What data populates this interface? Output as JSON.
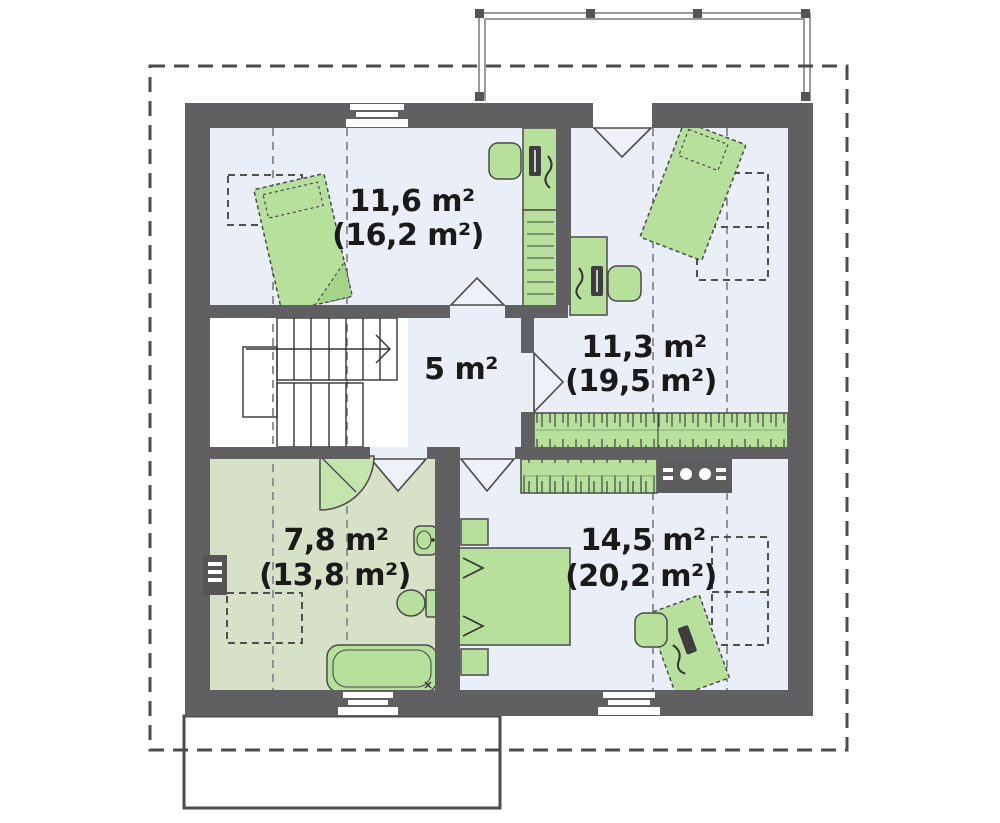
{
  "plan": {
    "type": "floor-plan",
    "floor": "attic storey",
    "rooms": [
      {
        "name": "room-top-left",
        "area": "11,6 m²",
        "total": "(16,2 m²)"
      },
      {
        "name": "room-right",
        "area": "11,3 m²",
        "total": "(19,5 m²)"
      },
      {
        "name": "hall",
        "area": "5 m²"
      },
      {
        "name": "bathroom",
        "area": "7,8 m²",
        "total": "(13,8 m²)"
      },
      {
        "name": "bedroom",
        "area": "14,5 m²",
        "total": "(20,2 m²)"
      }
    ],
    "colors": {
      "wall": "#606062",
      "floor": "#eaeef7",
      "bathroom_floor": "#d6e1c8",
      "stairwell": "#ffffff",
      "furniture_green": "#b6e09c",
      "roof_outline": "#4c4c4c",
      "label_text": "#1a1a1a"
    }
  }
}
